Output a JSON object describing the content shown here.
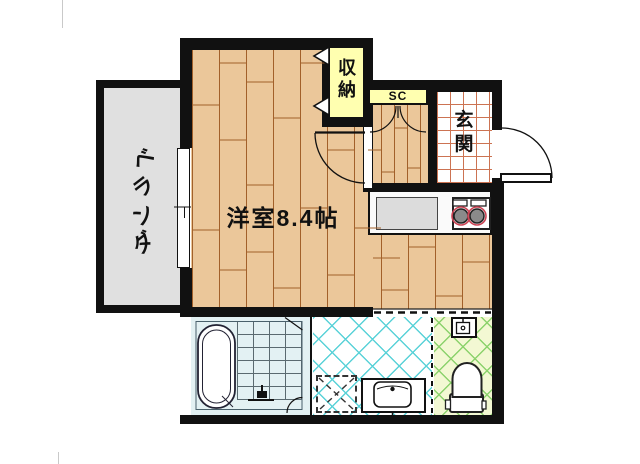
{
  "plan": {
    "title": "studio-apartment-floorplan",
    "rooms": {
      "balcony": {
        "label": "ベランダ"
      },
      "main_room": {
        "label": "洋室8.4帖",
        "size_jo": 8.4
      },
      "closet": {
        "label": "収納"
      },
      "shoe_closet": {
        "label": "SC"
      },
      "entrance": {
        "label": "玄関"
      }
    },
    "icons": {
      "bathtub-icon": "rounded-rect-double-outline",
      "shower-tap-icon": "small-black-tap-shape",
      "toilet-icon": "bowl-and-tank-outline",
      "corner-sink-icon": "small-square-basin",
      "vanity-sink-icon": "rounded-square-basin-with-faucet-dot",
      "washing-machine-pan-icon": "dashed-square-with-x",
      "stove-burners-icon": "two-circles-with-red-rings",
      "kitchen-counter-icon": "gray-rectangle",
      "entrance-door-icon": "quarter-arc-with-leaf",
      "room-door-icon": "quarter-arc-with-leaf",
      "shoe-closet-doors-icon": "double-quarter-arcs",
      "closet-folding-doors-icon": "double-chevrons",
      "window-icon": "white-gap-with-tick"
    },
    "colors": {
      "wall": "#111111",
      "wood_floor_fill": "#ebc79a",
      "wood_floor_line": "#a2602a",
      "balcony_fill": "#e0e0e0",
      "closet_fill": "#ffffb0",
      "entrance_tile_line": "#cc7352",
      "bathroom_fill": "#e3f1f3",
      "washroom_hatch": "#5ad2d8",
      "toilet_room_fill": "#f3f8d3",
      "toilet_room_hatch": "#8cd26c",
      "burner_ring": "#cc4455"
    }
  }
}
